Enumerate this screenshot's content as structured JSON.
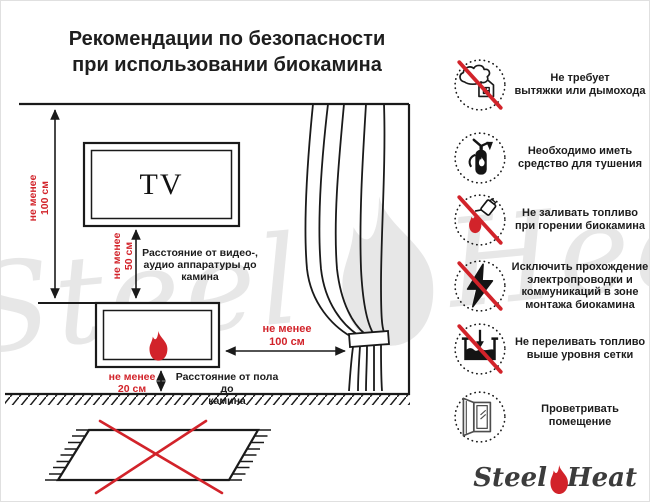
{
  "title": "Рекомендации по безопасности\nпри использовании биокамина",
  "diagram": {
    "tv_label": "TV",
    "ceiling_clearance": "не менее\n100 см",
    "tv_clearance": "не менее\n50 см",
    "tv_clearance_desc": "Расстояние от видео-,\nаудио аппаратуры до\nкамина",
    "curtain_clearance": "не менее\n100 см",
    "floor_clearance": "не менее\n20 см",
    "floor_clearance_desc": "Расстояние от пола до\nкамина"
  },
  "rules": [
    {
      "icon": "no-chimney-icon",
      "crossed": true,
      "label": "Не требует\nвытяжки или дымохода"
    },
    {
      "icon": "extinguisher-icon",
      "crossed": false,
      "label": "Необходимо иметь\nсредство для тушения"
    },
    {
      "icon": "no-refuel-icon",
      "crossed": true,
      "label": "Не заливать топливо\nпри горении биокамина"
    },
    {
      "icon": "no-wiring-icon",
      "crossed": true,
      "label": "Исключить прохождение\nэлектропроводки и\nкоммуникаций в зоне\nмонтажа биокамина"
    },
    {
      "icon": "no-overfill-icon",
      "crossed": true,
      "label": "Не переливать топливо\nвыше уровня сетки"
    },
    {
      "icon": "ventilate-icon",
      "crossed": false,
      "label": "Проветривать\nпомещение"
    }
  ],
  "watermark": {
    "text1": "Steel",
    "text2": "Heat"
  },
  "logo": {
    "text1": "Steel",
    "text2": "Heat"
  },
  "colors": {
    "accent_red": "#d2232a",
    "line_black": "#1a1a1a",
    "watermark_gray": "#e7e7e7"
  }
}
